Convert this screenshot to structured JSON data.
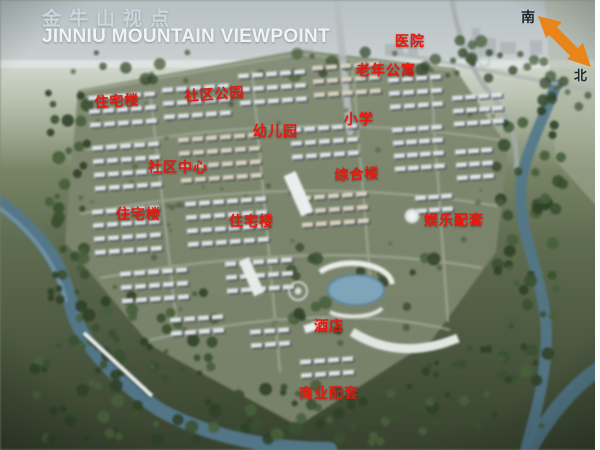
{
  "title": {
    "zh": "金牛山视点",
    "en": "JINNIU MOUNTAIN VIEWPOINT"
  },
  "compass": {
    "south_label": "南",
    "north_label": "北"
  },
  "map_labels": [
    {
      "text": "医院"
    },
    {
      "text": "老年公寓"
    },
    {
      "text": "住宅楼"
    },
    {
      "text": "社区公园"
    },
    {
      "text": "幼儿园"
    },
    {
      "text": "小学"
    },
    {
      "text": "社区中心"
    },
    {
      "text": "综合楼"
    },
    {
      "text": "住宅楼"
    },
    {
      "text": "住宅楼"
    },
    {
      "text": "娱乐配套"
    },
    {
      "text": "酒店"
    },
    {
      "text": "商业配套"
    }
  ],
  "colors": {
    "label_red": "#e6190e",
    "arrow_orange": "#e98418",
    "title_white": "#eef3f5",
    "water_blue": "#50798f",
    "sky_haze": "#c6cfd1"
  }
}
